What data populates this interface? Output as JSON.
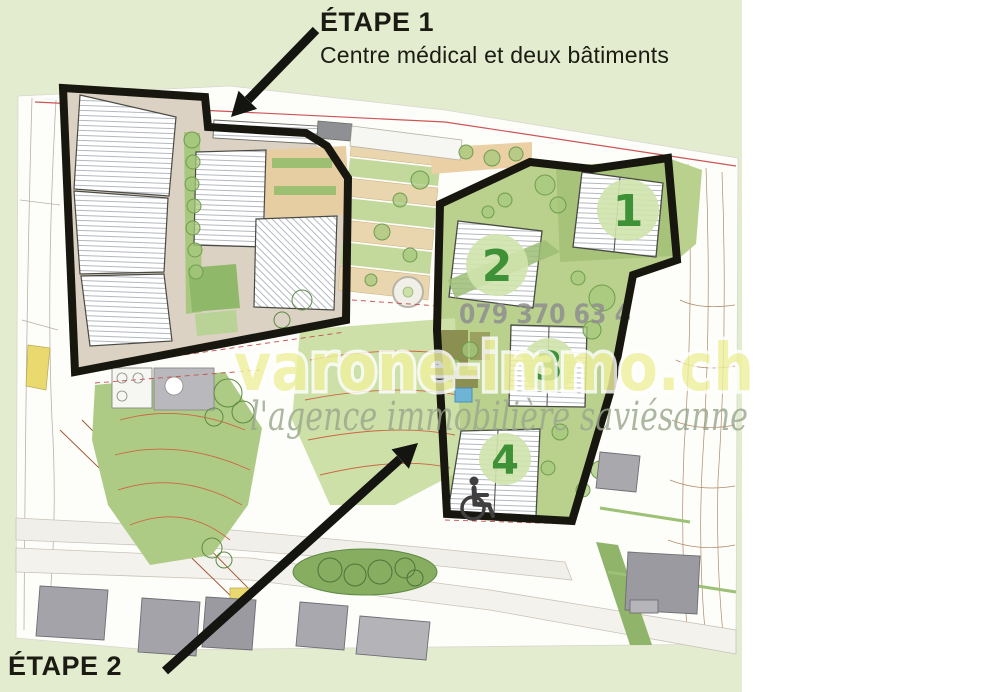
{
  "page": {
    "background": "#ffffff",
    "card_color": "#e3ecce"
  },
  "annotations": {
    "etape1_title": "ÉTAPE 1",
    "etape1_subtitle": "Centre médical et deux bâtiments",
    "etape2_title": "ÉTAPE 2",
    "arrow_color": "#141410"
  },
  "watermark": {
    "site": "varone-immo.ch",
    "tagline": "l'agence immobilière saviésanne",
    "phone": "079 370 63 4",
    "site_color": "#eef09e",
    "tagline_color": "#99a68c",
    "phone_color": "#8f8f8f"
  },
  "plan": {
    "building_numbers": [
      "1",
      "2",
      "3",
      "4"
    ],
    "number_color": "#3f9138",
    "number_circle_color": "#cfe3ab",
    "zone_outline_color": "#17170f",
    "greenery_color": "#b9d18d",
    "building_fill": "#ffffff",
    "existing_building_color": "#9a9aa0",
    "icons": {
      "wheelchair": "wheelchair-icon",
      "arrow_down_left": "arrow-down-left-icon",
      "arrow_up_right": "arrow-up-right-icon"
    }
  }
}
